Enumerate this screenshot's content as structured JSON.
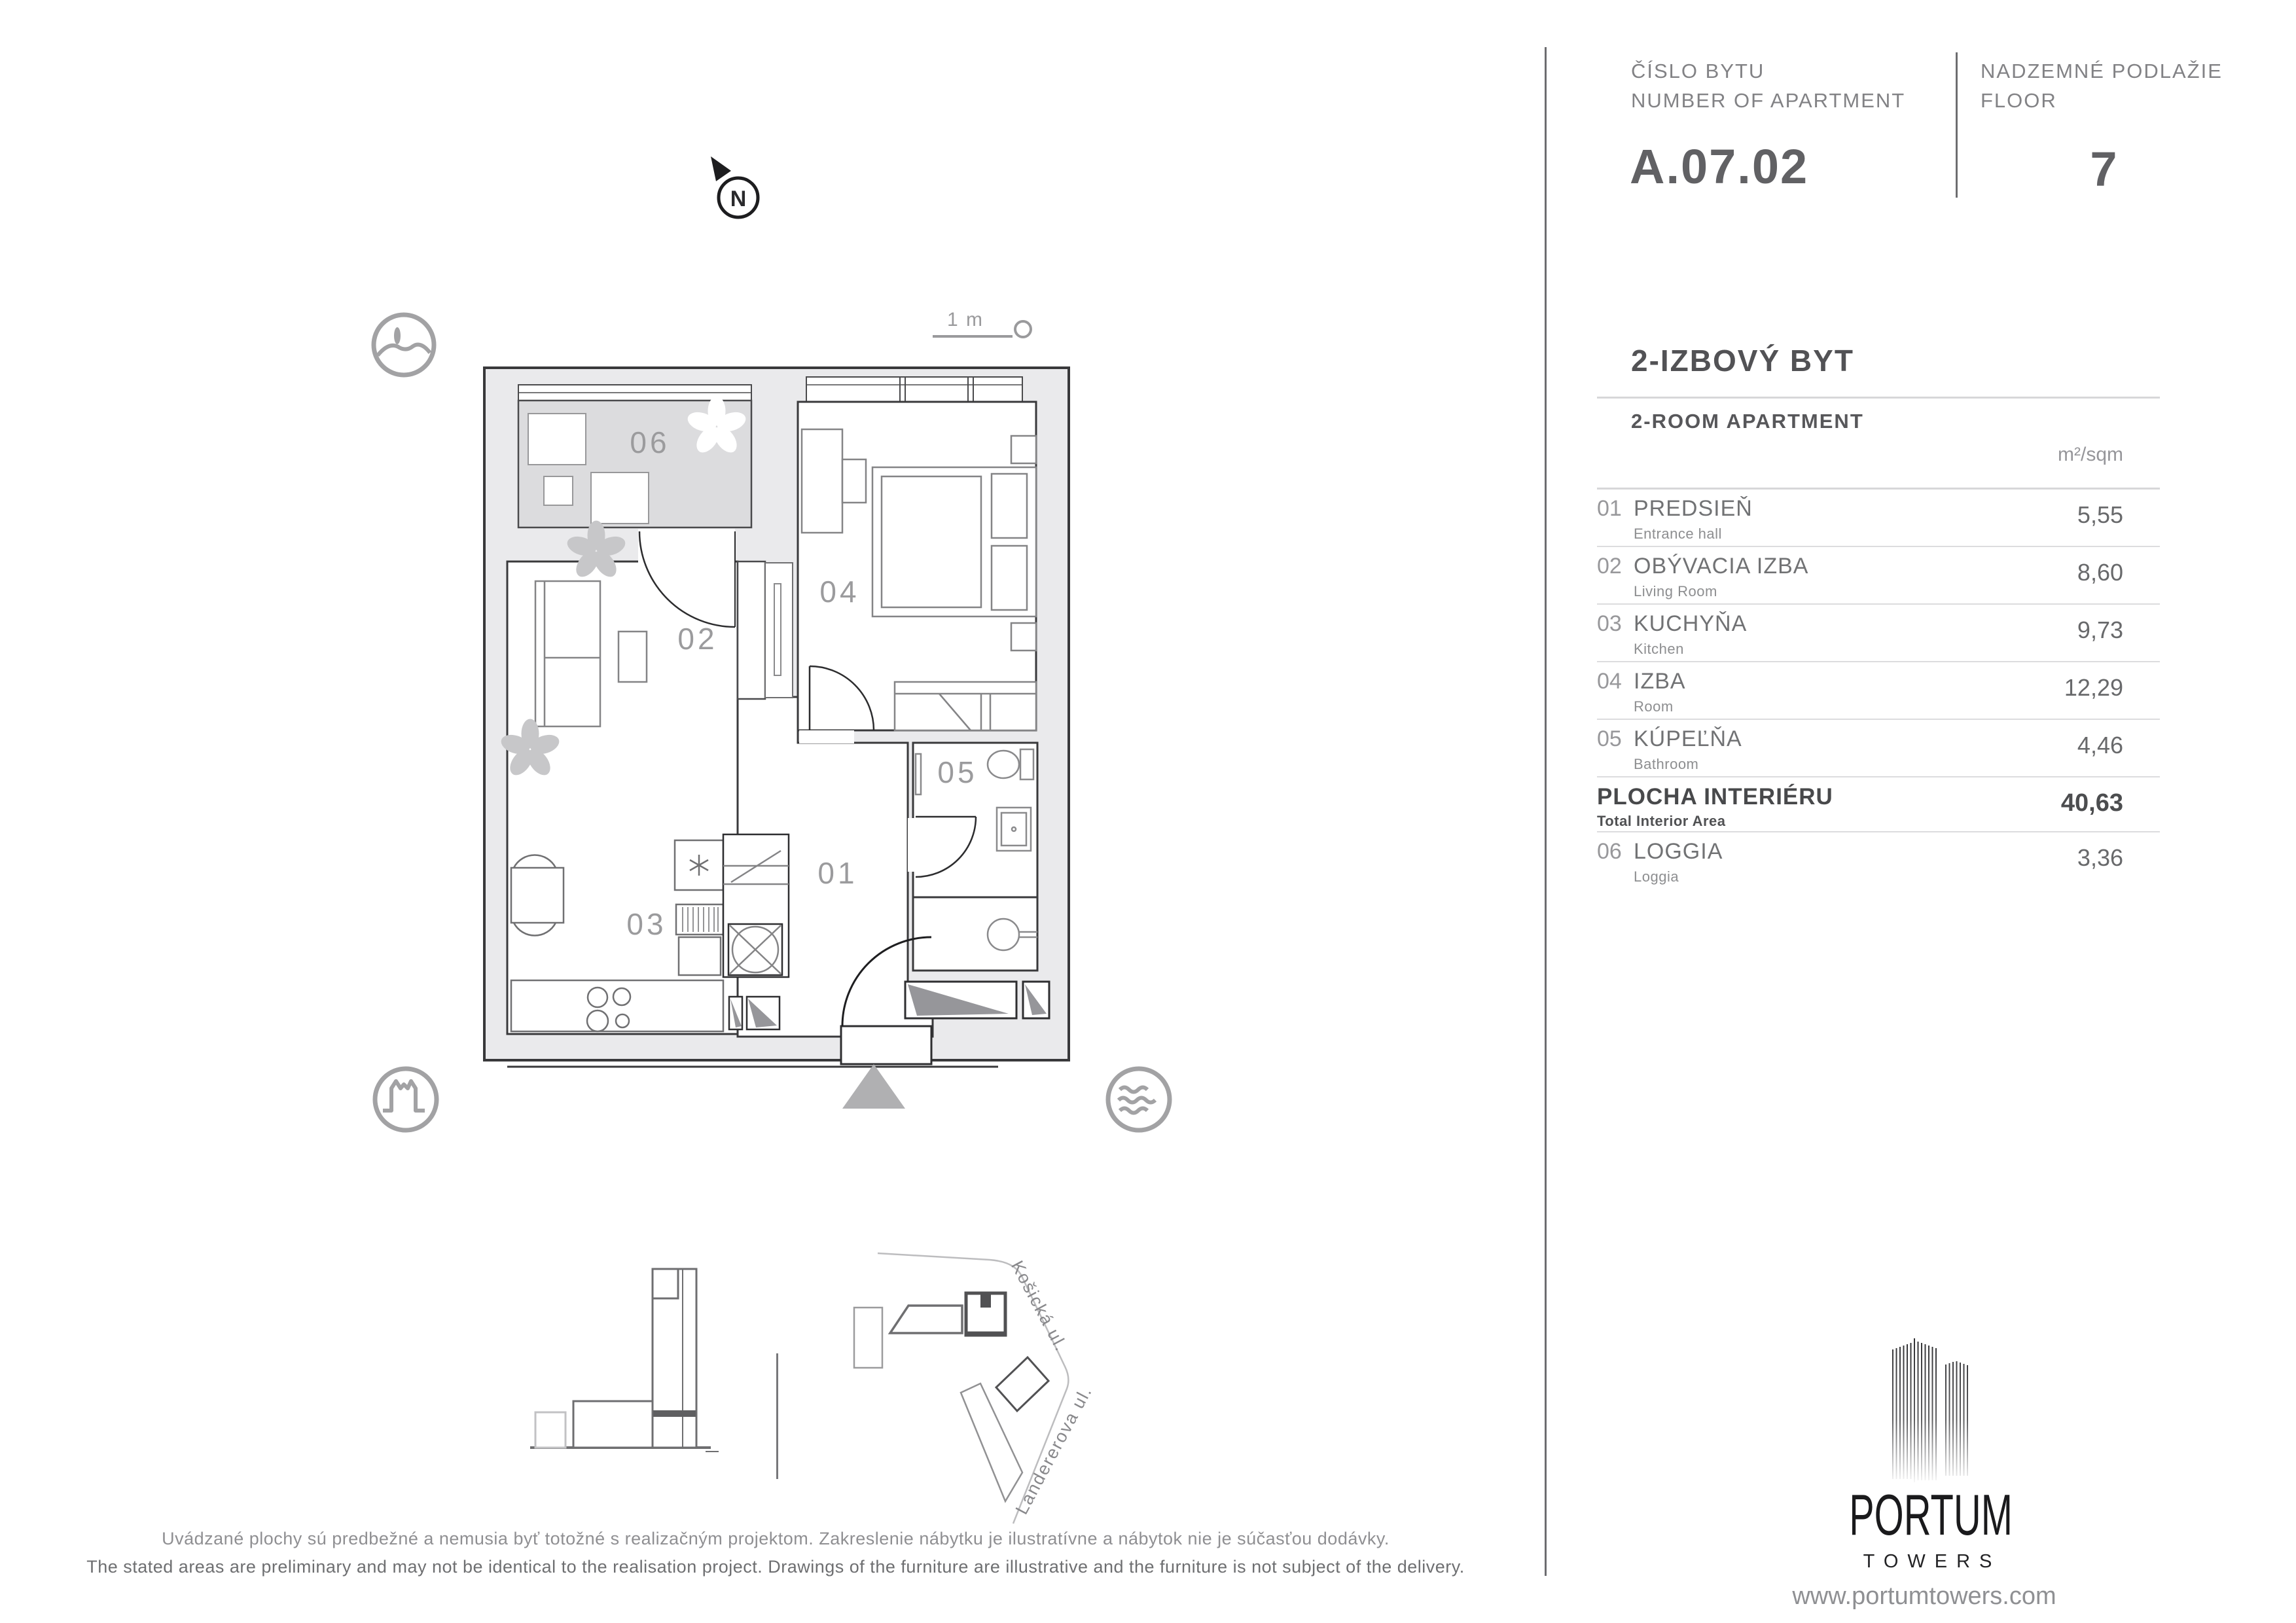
{
  "header": {
    "apartment_no_label_sk": "ČÍSLO BYTU",
    "apartment_no_label_en": "NUMBER OF APARTMENT",
    "apartment_number": "A.07.02",
    "floor_label_sk": "NADZEMNÉ PODLAŽIE",
    "floor_label_en": "FLOOR",
    "floor_number": "7"
  },
  "apartment": {
    "title_sk": "2-IZBOVÝ BYT",
    "title_en": "2-ROOM APARTMENT",
    "unit_header": "m²/sqm",
    "rooms": [
      {
        "num": "01",
        "name_sk": "PREDSIEŇ",
        "name_en": "Entrance hall",
        "area": "5,55"
      },
      {
        "num": "02",
        "name_sk": "OBÝVACIA IZBA",
        "name_en": "Living Room",
        "area": "8,60"
      },
      {
        "num": "03",
        "name_sk": "KUCHYŇA",
        "name_en": "Kitchen",
        "area": "9,73"
      },
      {
        "num": "04",
        "name_sk": "IZBA",
        "name_en": "Room",
        "area": "12,29"
      },
      {
        "num": "05",
        "name_sk": "KÚPEĽŇA",
        "name_en": "Bathroom",
        "area": "4,46"
      }
    ],
    "total": {
      "name_sk": "PLOCHA INTERIÉRU",
      "name_en": "Total Interior Area",
      "area": "40,63"
    },
    "loggia": {
      "num": "06",
      "name_sk": "LOGGIA",
      "name_en": "Loggia",
      "area": "3,36"
    }
  },
  "plan": {
    "labels": {
      "r01": "01",
      "r02": "02",
      "r03": "03",
      "r04": "04",
      "r05": "05",
      "r06": "06"
    },
    "north": "N",
    "scale": "1 m"
  },
  "site": {
    "street1": "Košická ul.",
    "street2": "Landererova ul."
  },
  "footer": {
    "disclaimer_sk": "Uvádzané plochy sú predbežné a nemusia byť totožné s realizačným projektom. Zakreslenie nábytku je ilustratívne a nábytok nie je súčasťou dodávky.",
    "disclaimer_en": "The stated areas are preliminary and may not be identical to the realisation project. Drawings of the furniture are illustrative and the furniture is not subject of the delivery.",
    "website": "www.portumtowers.com"
  },
  "logo": {
    "name": "PORTUM",
    "sub": "TOWERS"
  },
  "colors": {
    "wall": "#eaeaec",
    "wall_stroke": "#39393b",
    "loggia_fill": "#dcdcde",
    "accent_gray": "#9b9b9d"
  }
}
